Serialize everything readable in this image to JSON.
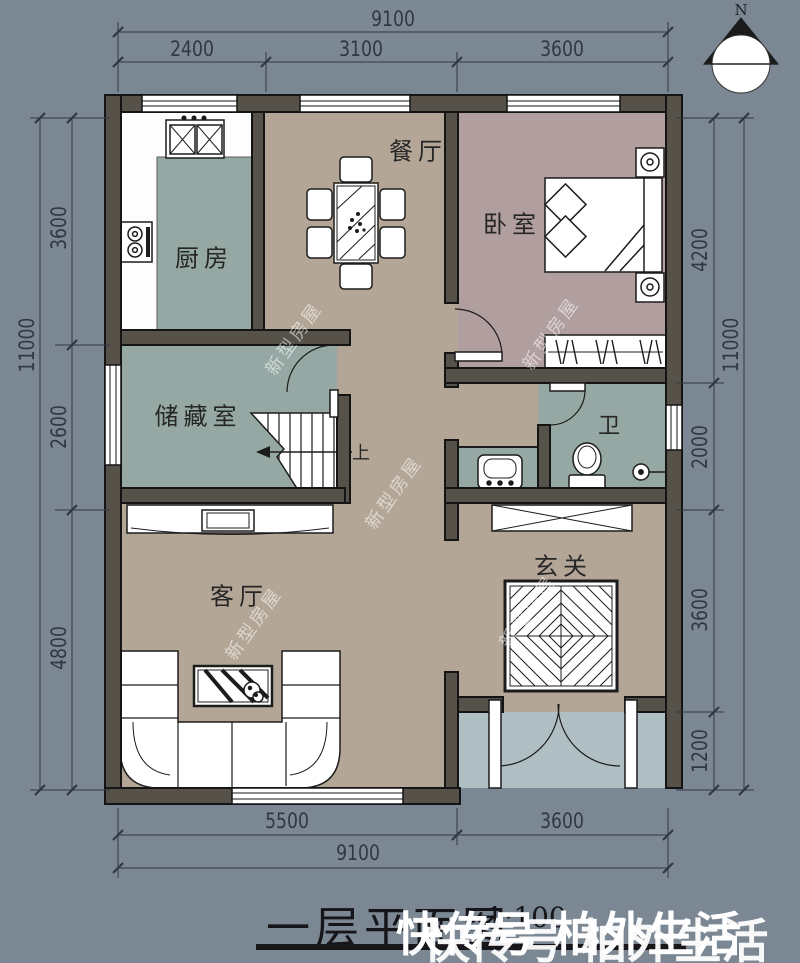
{
  "meta": {
    "title": "一层平面图",
    "scale": "1:100"
  },
  "compass": {
    "label": "N"
  },
  "rooms": {
    "kitchen": {
      "label": "厨房"
    },
    "dining": {
      "label": "餐厅"
    },
    "bedroom": {
      "label": "卧室"
    },
    "storage": {
      "label": "储藏室"
    },
    "bath": {
      "label": "卫"
    },
    "living": {
      "label": "客厅"
    },
    "foyer": {
      "label": "玄关"
    }
  },
  "stairs": {
    "up_label": "上"
  },
  "dimensions": {
    "top": {
      "total": "9100",
      "segments": [
        "2400",
        "3100",
        "3600"
      ]
    },
    "bottom": {
      "total": "9100",
      "segments": [
        "5500",
        "3600"
      ]
    },
    "left": {
      "total": "11000",
      "segments": [
        "3600",
        "2600",
        "4800"
      ]
    },
    "right": {
      "total": "11000",
      "segments": [
        "4200",
        "2000",
        "3600",
        "1200"
      ]
    }
  },
  "watermark": {
    "text": "新型房屋",
    "overlay_line": "快传号 柏外生活"
  },
  "colors": {
    "background": "#7B8894",
    "wall": "#56524A",
    "floor_tan": "#B4A697",
    "floor_teal": "#95A8A4",
    "floor_mauve": "#B19E9E",
    "porch": "#AFBFC4",
    "line_ink": "#1C1C1C",
    "dim_text": "#2F3842",
    "watermark_white": "#FFFFFF"
  }
}
